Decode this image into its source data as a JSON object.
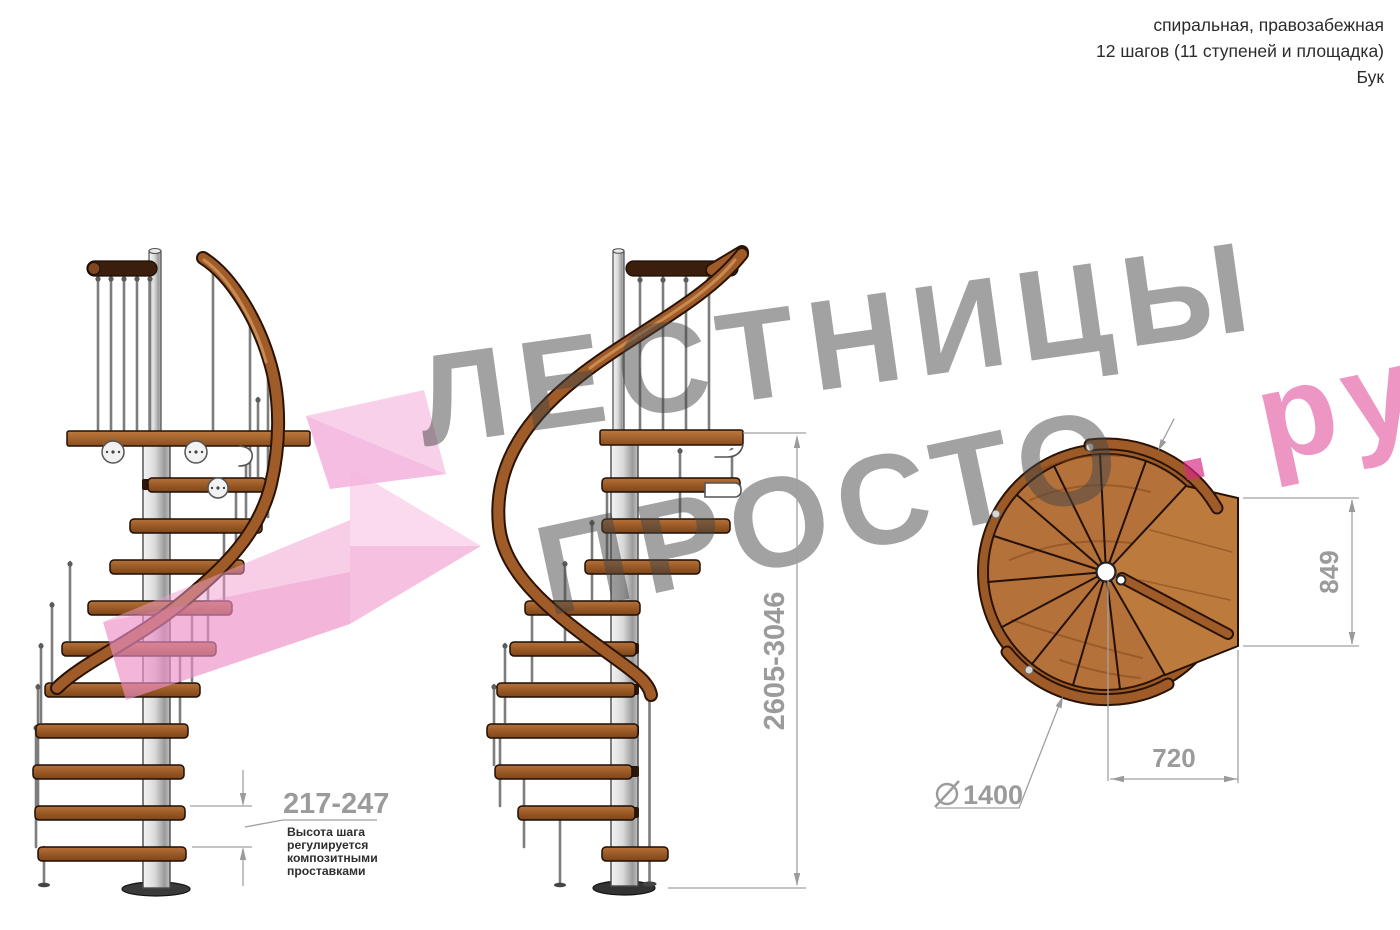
{
  "header": {
    "line1": "спиральная, правозабежная",
    "line2": "12 шагов (11 ступеней и площадка)",
    "line3": "Бук"
  },
  "watermark": {
    "word1": "ЛЕСТНИЦЫ",
    "word2": "ПРОСТО",
    "dot": ".",
    "suffix": "ру",
    "gray_color": "#9e9e9e",
    "pink_color": "#e8559c"
  },
  "dimensions": {
    "step_height": "217-247",
    "total_height": "2605-3046",
    "platform_side": "849",
    "platform_width": "720",
    "diameter_symbol": "⌀",
    "diameter": "1400",
    "note": {
      "l1": "Высота шага",
      "l2": "регулируется",
      "l3": "композитными",
      "l4": "проставками"
    },
    "dim_color": "#9b9b9b"
  },
  "materials": {
    "wood": "#b5713a",
    "wood_dark": "#7e4418",
    "handrail": "#a05c28",
    "top_rail": "#3c1e0c",
    "pole": "#c9c9c9"
  }
}
